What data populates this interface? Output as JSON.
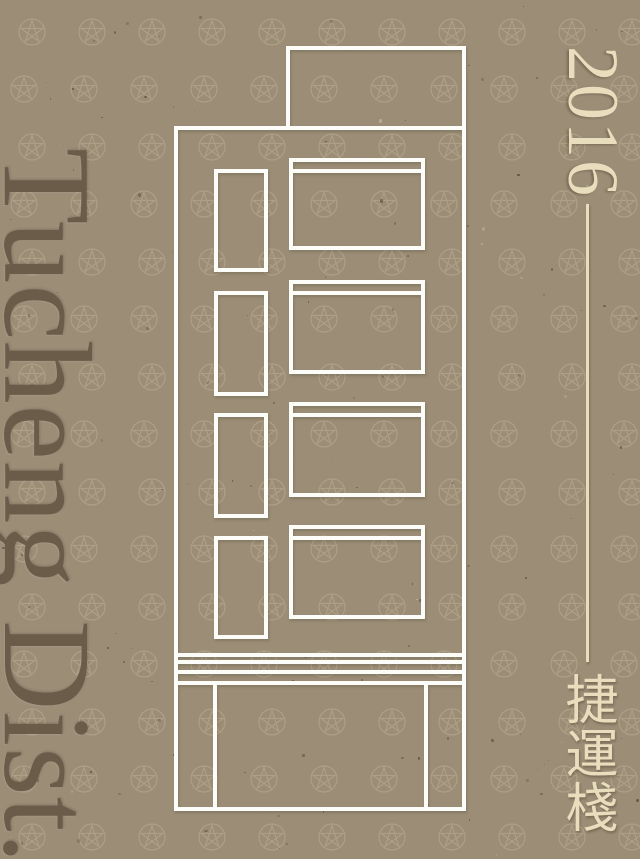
{
  "poster": {
    "district_label": "Tucheng Dist.",
    "year_label": "2016",
    "cjk_label": "捷運棧",
    "colors": {
      "background": "#9C8E77",
      "district_text": "#6B5C4A",
      "accent_cream": "#E8DDBD",
      "line_art": "#FCFCF9"
    },
    "motif": "star-in-circle-pattern",
    "illustration": "four-storey building facade white line drawing"
  }
}
